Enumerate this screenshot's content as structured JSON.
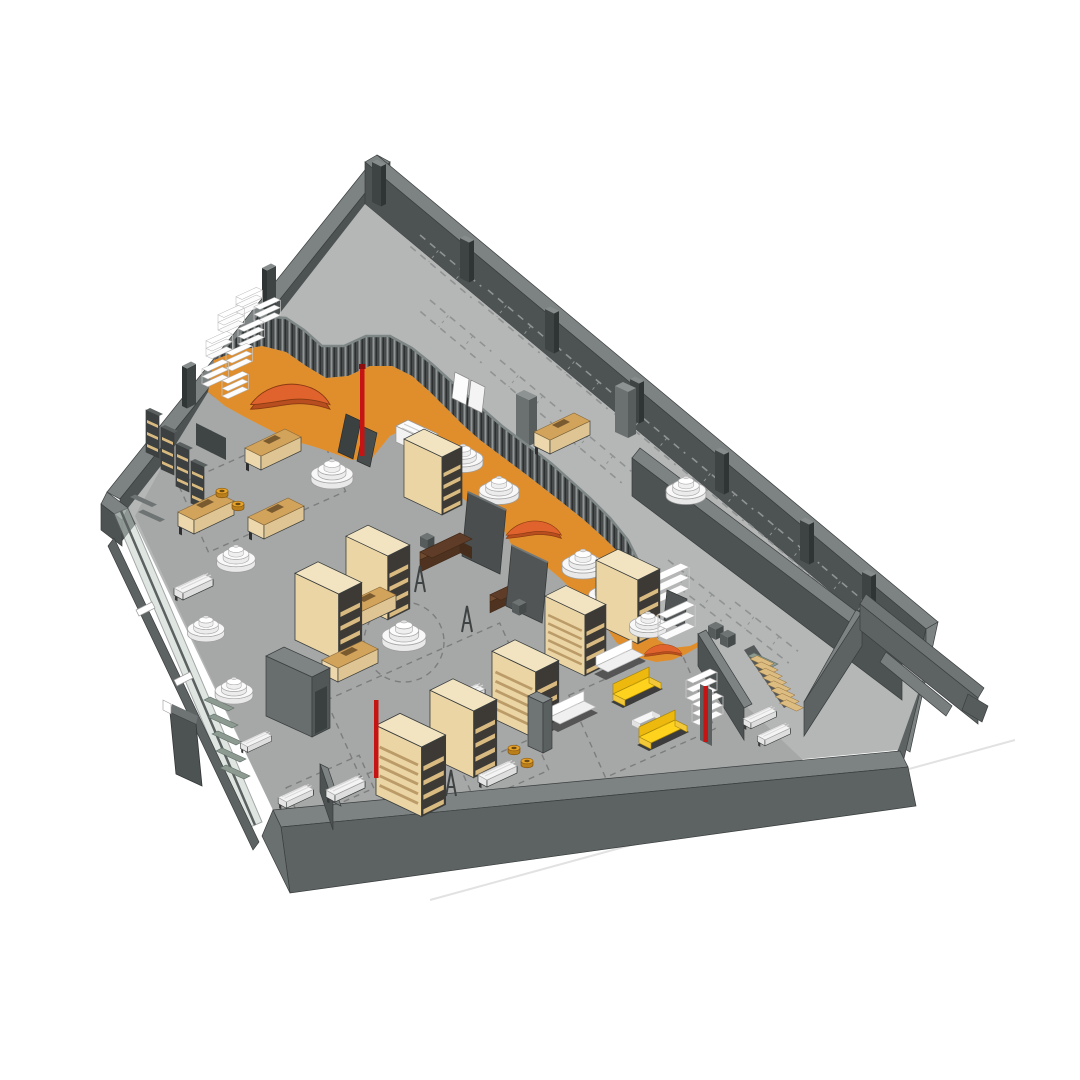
{
  "scene": {
    "type": "3d-isometric-architectural-render",
    "setting": "retail-store-floor-plan",
    "view": "axonometric-from-southeast",
    "objects": [
      {
        "name": "outer-wall",
        "count": 4
      },
      {
        "name": "back-corridor-floor",
        "count": 1
      },
      {
        "name": "serpentine-slatted-partition",
        "count": 1
      },
      {
        "name": "orange-walkway",
        "count": 1
      },
      {
        "name": "sales-floor",
        "count": 1
      },
      {
        "name": "glass-storefront",
        "count": 1
      },
      {
        "name": "display-cabinet",
        "count": 8
      },
      {
        "name": "display-table",
        "count": 6
      },
      {
        "name": "round-tier-display",
        "count": 11
      },
      {
        "name": "white-bench",
        "count": 8
      },
      {
        "name": "yellow-sofa",
        "count": 2
      },
      {
        "name": "white-sofa",
        "count": 2
      },
      {
        "name": "curved-orange-sofa",
        "count": 3
      },
      {
        "name": "brown-sofa-table",
        "count": 2
      },
      {
        "name": "white-shelf-stack",
        "count": 13
      },
      {
        "name": "wall-shelf-unit",
        "count": 6
      },
      {
        "name": "fitting-room-block",
        "count": 1
      },
      {
        "name": "security-gate-with-red-pole",
        "count": 1
      },
      {
        "name": "red-strip",
        "count": 2
      },
      {
        "name": "wood-staircase",
        "count": 1
      },
      {
        "name": "orange-stool",
        "count": 4
      },
      {
        "name": "poster-board",
        "count": 4
      },
      {
        "name": "easel-stand",
        "count": 3
      },
      {
        "name": "column",
        "count": 2
      },
      {
        "name": "pilaster",
        "count": 9
      },
      {
        "name": "exterior-sign-panel",
        "count": 1
      },
      {
        "name": "entry-vestibule",
        "count": 1
      }
    ]
  },
  "palette": {
    "background": "#ffffff",
    "wall-top": "#7d8282",
    "wall-outer": "#5d6262",
    "wall-face": "#4d5252",
    "wall-top-light": "#8f9494",
    "floor-back": "#b5b6b6",
    "floor-sales": "#a6a7a7",
    "walkway": "#e08e2c",
    "partition": "#474b4b",
    "partition-cap": "#7e8686",
    "slat-light": "#909696",
    "slat-dark": "#2c3030",
    "cabinet-top": "#f2e4c1",
    "cabinet-front": "#ebd5a5",
    "cabinet-side": "#3d3a35",
    "cabinet-shelf": "#d9ba80",
    "table-top": "#d2a35b",
    "table-side": "#ecd8ac",
    "wood-brown": "#5f3c27",
    "bench-white": "#f4f4f4",
    "sofa-yellow": "#ffd21e",
    "sofa-yellow-shade": "#edb90e",
    "sofa-orange": "#e0632d",
    "sofa-orange-dark": "#b84e1f",
    "display-white": "#f8f8f8",
    "glass": "#c6d2cc",
    "stair-wood": "#dcbc80",
    "red": "#c41414",
    "dash-back": "#8f9393",
    "dash-sales": "#7d7d7d",
    "line-faint": "#e2e2e2",
    "outline": "#3a3e3e"
  }
}
